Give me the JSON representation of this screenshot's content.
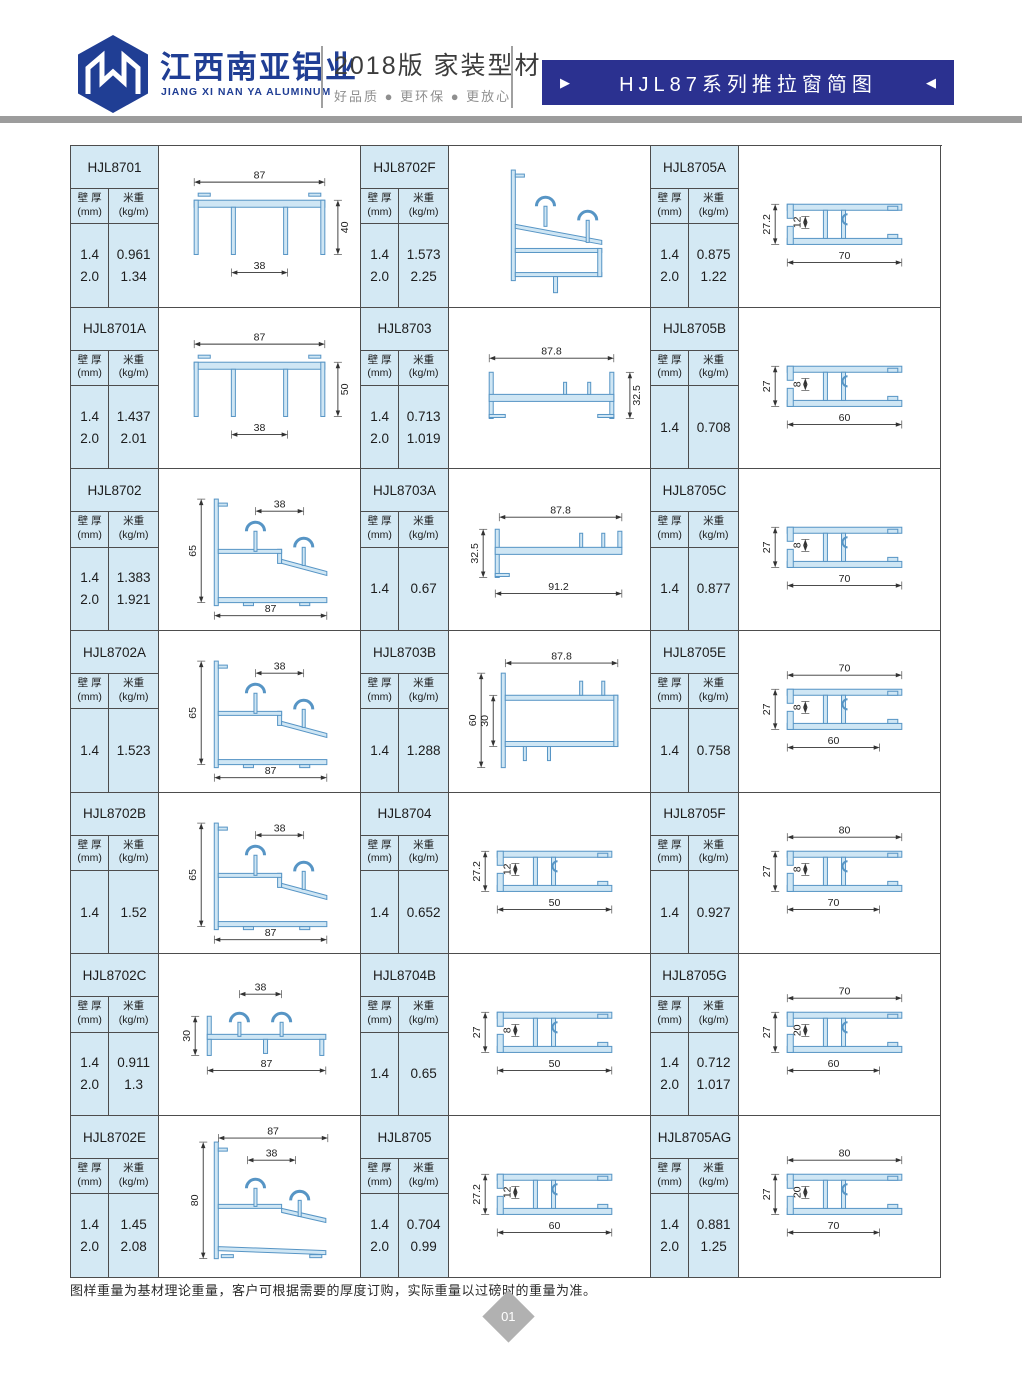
{
  "header": {
    "company_cn": "江西南亚铝业",
    "company_en": "JIANG XI NAN YA ALUMINUM",
    "edition": "2018版  家装型材",
    "tagline": "好品质 ● 更环保 ● 更放心",
    "banner_title": "HJL87系列推拉窗简图",
    "banner_left_arrow": "▶",
    "banner_right_arrow": "◀"
  },
  "table_labels": {
    "col1_line1": "壁 厚",
    "col1_line2": "(mm)",
    "col2_line1": "米重",
    "col2_line2": "(kg/m)"
  },
  "cells": [
    {
      "model": "HJL8701",
      "rows": [
        [
          "1.4",
          "0.961"
        ],
        [
          "2.0",
          "1.34"
        ]
      ],
      "kind": "bottomrail",
      "dims": [
        {
          "pos": "top",
          "v": "87"
        },
        {
          "pos": "bottom",
          "v": "38"
        },
        {
          "pos": "right",
          "v": "40"
        }
      ]
    },
    {
      "model": "HJL8702F",
      "rows": [
        [
          "1.4",
          "1.573"
        ],
        [
          "2.0",
          "2.25"
        ]
      ],
      "kind": "slopeF",
      "dims": []
    },
    {
      "model": "HJL8705A",
      "rows": [
        [
          "1.4",
          "0.875"
        ],
        [
          "2.0",
          "1.22"
        ]
      ],
      "kind": "tube",
      "dims": [
        {
          "pos": "left",
          "v": "27.2"
        },
        {
          "pos": "left2",
          "v": "12"
        },
        {
          "pos": "bottom",
          "v": "70"
        }
      ]
    },
    {
      "model": "HJL8701A",
      "rows": [
        [
          "1.4",
          "1.437"
        ],
        [
          "2.0",
          "2.01"
        ]
      ],
      "kind": "bottomrail",
      "dims": [
        {
          "pos": "top",
          "v": "87"
        },
        {
          "pos": "bottom",
          "v": "38"
        },
        {
          "pos": "right",
          "v": "50"
        }
      ]
    },
    {
      "model": "HJL8703",
      "rows": [
        [
          "1.4",
          "0.713"
        ],
        [
          "2.0",
          "1.019"
        ]
      ],
      "kind": "channel",
      "dims": [
        {
          "pos": "top",
          "v": "87.8"
        },
        {
          "pos": "right",
          "v": "32.5"
        }
      ]
    },
    {
      "model": "HJL8705B",
      "rows": [
        [
          "1.4",
          "0.708"
        ]
      ],
      "kind": "tube",
      "dims": [
        {
          "pos": "left",
          "v": "27"
        },
        {
          "pos": "left2",
          "v": "8"
        },
        {
          "pos": "bottom",
          "v": "60"
        }
      ]
    },
    {
      "model": "HJL8702",
      "rows": [
        [
          "1.4",
          "1.383"
        ],
        [
          "2.0",
          "1.921"
        ]
      ],
      "kind": "slope",
      "dims": [
        {
          "pos": "top",
          "v": "38"
        },
        {
          "pos": "left",
          "v": "65"
        },
        {
          "pos": "bottom",
          "v": "87"
        }
      ]
    },
    {
      "model": "HJL8703A",
      "rows": [
        [
          "1.4",
          "0.67"
        ]
      ],
      "kind": "channel2",
      "dims": [
        {
          "pos": "top",
          "v": "87.8"
        },
        {
          "pos": "left",
          "v": "32.5"
        },
        {
          "pos": "bottom",
          "v": "91.2"
        }
      ]
    },
    {
      "model": "HJL8705C",
      "rows": [
        [
          "1.4",
          "0.877"
        ]
      ],
      "kind": "tube",
      "dims": [
        {
          "pos": "left",
          "v": "27"
        },
        {
          "pos": "left2",
          "v": "8"
        },
        {
          "pos": "bottom",
          "v": "70"
        }
      ]
    },
    {
      "model": "HJL8702A",
      "rows": [
        [
          "1.4",
          "1.523"
        ]
      ],
      "kind": "slope",
      "dims": [
        {
          "pos": "top",
          "v": "38"
        },
        {
          "pos": "left",
          "v": "65"
        },
        {
          "pos": "bottom",
          "v": "87"
        }
      ]
    },
    {
      "model": "HJL8703B",
      "rows": [
        [
          "1.4",
          "1.288"
        ]
      ],
      "kind": "box",
      "dims": [
        {
          "pos": "top",
          "v": "87.8"
        },
        {
          "pos": "left",
          "v": "60"
        },
        {
          "pos": "left2",
          "v": "30"
        }
      ]
    },
    {
      "model": "HJL8705E",
      "rows": [
        [
          "1.4",
          "0.758"
        ]
      ],
      "kind": "tube2",
      "dims": [
        {
          "pos": "top",
          "v": "70"
        },
        {
          "pos": "left",
          "v": "27"
        },
        {
          "pos": "left2",
          "v": "8"
        },
        {
          "pos": "bottom",
          "v": "60"
        }
      ]
    },
    {
      "model": "HJL8702B",
      "rows": [
        [
          "1.4",
          "1.52"
        ]
      ],
      "kind": "slope",
      "dims": [
        {
          "pos": "top",
          "v": "38"
        },
        {
          "pos": "left",
          "v": "65"
        },
        {
          "pos": "bottom",
          "v": "87"
        }
      ]
    },
    {
      "model": "HJL8704",
      "rows": [
        [
          "1.4",
          "0.652"
        ]
      ],
      "kind": "tube",
      "dims": [
        {
          "pos": "left",
          "v": "27.2"
        },
        {
          "pos": "left2",
          "v": "12"
        },
        {
          "pos": "bottom",
          "v": "50"
        }
      ]
    },
    {
      "model": "HJL8705F",
      "rows": [
        [
          "1.4",
          "0.927"
        ]
      ],
      "kind": "tube2",
      "dims": [
        {
          "pos": "top",
          "v": "80"
        },
        {
          "pos": "left",
          "v": "27"
        },
        {
          "pos": "left2",
          "v": "8"
        },
        {
          "pos": "bottom",
          "v": "70"
        }
      ]
    },
    {
      "model": "HJL8702C",
      "rows": [
        [
          "1.4",
          "0.911"
        ],
        [
          "2.0",
          "1.3"
        ]
      ],
      "kind": "slope30",
      "dims": [
        {
          "pos": "top",
          "v": "38"
        },
        {
          "pos": "left",
          "v": "30"
        },
        {
          "pos": "bottom",
          "v": "87"
        }
      ]
    },
    {
      "model": "HJL8704B",
      "rows": [
        [
          "1.4",
          "0.65"
        ]
      ],
      "kind": "tube",
      "dims": [
        {
          "pos": "left",
          "v": "27"
        },
        {
          "pos": "left2",
          "v": "8"
        },
        {
          "pos": "bottom",
          "v": "50"
        }
      ]
    },
    {
      "model": "HJL8705G",
      "rows": [
        [
          "1.4",
          "0.712"
        ],
        [
          "2.0",
          "1.017"
        ]
      ],
      "kind": "tube2",
      "dims": [
        {
          "pos": "top",
          "v": "70"
        },
        {
          "pos": "left",
          "v": "27"
        },
        {
          "pos": "left2",
          "v": "20"
        },
        {
          "pos": "bottom",
          "v": "60"
        }
      ]
    },
    {
      "model": "HJL8702E",
      "rows": [
        [
          "1.4",
          "1.45"
        ],
        [
          "2.0",
          "2.08"
        ]
      ],
      "kind": "slopeE",
      "dims": [
        {
          "pos": "top",
          "v": "87"
        },
        {
          "pos": "top2",
          "v": "38"
        },
        {
          "pos": "left",
          "v": "80"
        }
      ]
    },
    {
      "model": "HJL8705",
      "rows": [
        [
          "1.4",
          "0.704"
        ],
        [
          "2.0",
          "0.99"
        ]
      ],
      "kind": "tube",
      "dims": [
        {
          "pos": "left",
          "v": "27.2"
        },
        {
          "pos": "left2",
          "v": "12"
        },
        {
          "pos": "bottom",
          "v": "60"
        }
      ]
    },
    {
      "model": "HJL8705AG",
      "rows": [
        [
          "1.4",
          "0.881"
        ],
        [
          "2.0",
          "1.25"
        ]
      ],
      "kind": "tube2",
      "dims": [
        {
          "pos": "top",
          "v": "80"
        },
        {
          "pos": "left",
          "v": "27"
        },
        {
          "pos": "left2",
          "v": "20"
        },
        {
          "pos": "bottom",
          "v": "70"
        }
      ]
    }
  ],
  "footer": {
    "note": "图样重量为基材理论重量，客户可根据需要的厚度订购，实际重量以过磅时的重量为准。",
    "page_number": "01"
  },
  "colors": {
    "banner_bg": "#2b3190",
    "logo_blue": "#203e94",
    "panel_bg": "#d4e9f4",
    "profile_stroke": "#5795c5",
    "profile_fill": "#cfe6f4",
    "grid_border": "#4d4d4d",
    "gray_bar": "#9c9c9c",
    "page_diamond": "#b1b1b1"
  }
}
